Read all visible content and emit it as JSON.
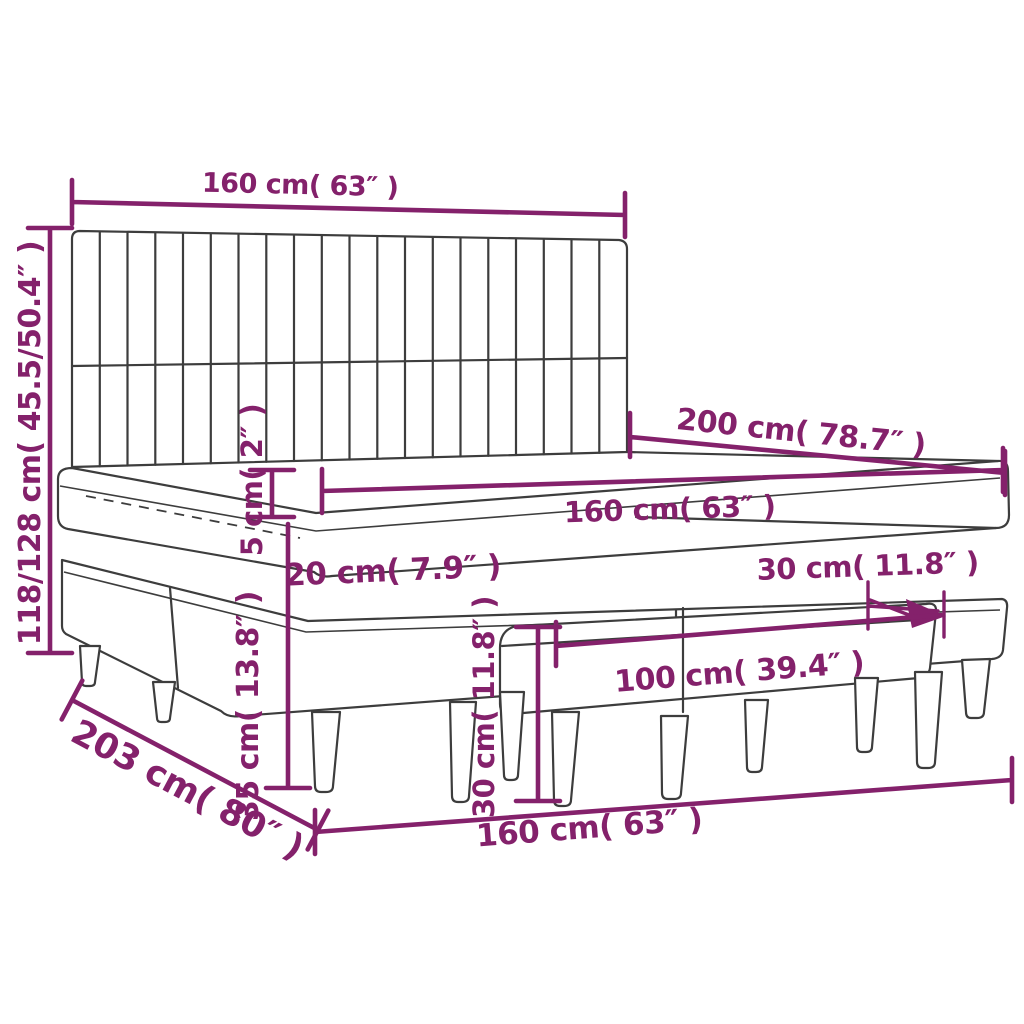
{
  "colors": {
    "accent": "#84216b",
    "line": "#3d3d3d",
    "background": "#ffffff"
  },
  "dims": {
    "headboard_width": {
      "label": "160 cm( 63″ )"
    },
    "overall_height": {
      "label": "118/128 cm( 45.5/50.4″ )"
    },
    "topper_thickness": {
      "label": "5 cm( 2″ )"
    },
    "bed_length": {
      "label": "200 cm( 78.7″ )"
    },
    "mattress_width": {
      "label": "160 cm( 63″ )"
    },
    "mattress_height": {
      "label": "20 cm( 7.9″ )"
    },
    "bench_depth": {
      "label": "30 cm( 11.8″ )"
    },
    "leg_height": {
      "label": "35 cm( 13.8″ )"
    },
    "bench_height": {
      "label": "30 cm( 11.8″ )"
    },
    "bench_length": {
      "label": "100 cm( 39.4″ )"
    },
    "overall_depth": {
      "label": "203 cm( 80″ )"
    },
    "base_width": {
      "label": "160 cm( 63″ )"
    }
  }
}
